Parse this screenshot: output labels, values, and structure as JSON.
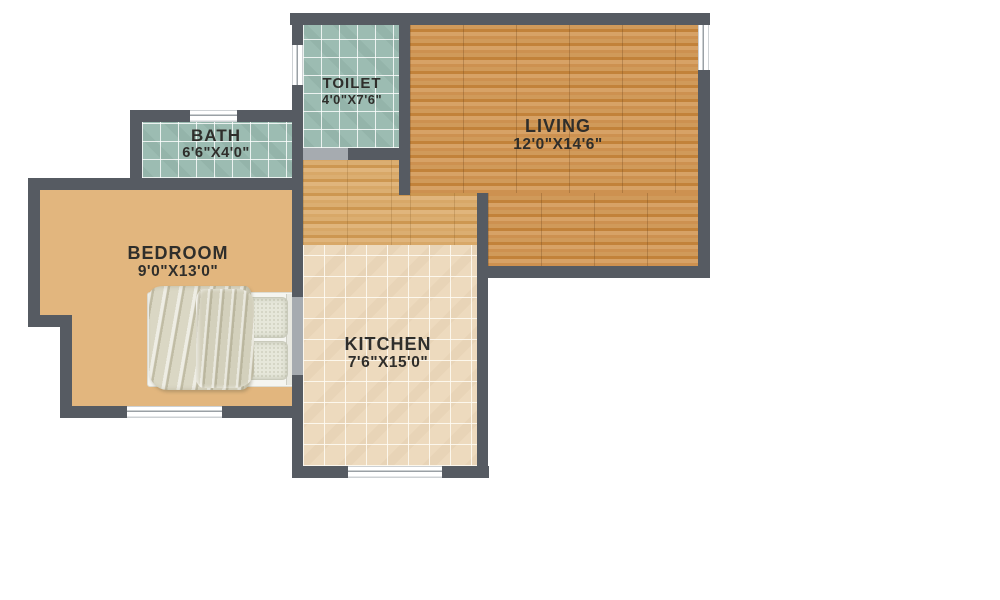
{
  "floorplan": {
    "title": "Apartment floor plan",
    "rooms": [
      {
        "id": "toilet",
        "name": "TOILET",
        "dims": "4'0\"X7'6\"",
        "floor": "teal-tile"
      },
      {
        "id": "bath",
        "name": "BATH",
        "dims": "6'6\"X4'0\"",
        "floor": "teal-tile"
      },
      {
        "id": "living",
        "name": "LIVING",
        "dims": "12'0\"X14'6\"",
        "floor": "wood-plank"
      },
      {
        "id": "bedroom",
        "name": "BEDROOM",
        "dims": "9'0\"X13'0\"",
        "floor": "light-wood-plank"
      },
      {
        "id": "kitchen",
        "name": "KITCHEN",
        "dims": "7'6\"X15'0\"",
        "floor": "beige-tile"
      }
    ],
    "furniture": [
      {
        "id": "bed",
        "room": "bedroom",
        "parts": [
          "frame",
          "duvet",
          "pillow-top",
          "pillow-bottom",
          "headboard"
        ]
      }
    ],
    "colors": {
      "wall": "#565b62",
      "door_opening": "#a6abb0",
      "window": "#ffffff",
      "tile_teal": "#9cbcb2",
      "tile_beige": "#eddabe",
      "wood_living": "#cc8f4b",
      "wood_hall": "#d6a463",
      "wood_bedroom": "#e2b67e",
      "label_text": "#2f2e2b",
      "background": "#ffffff"
    }
  }
}
